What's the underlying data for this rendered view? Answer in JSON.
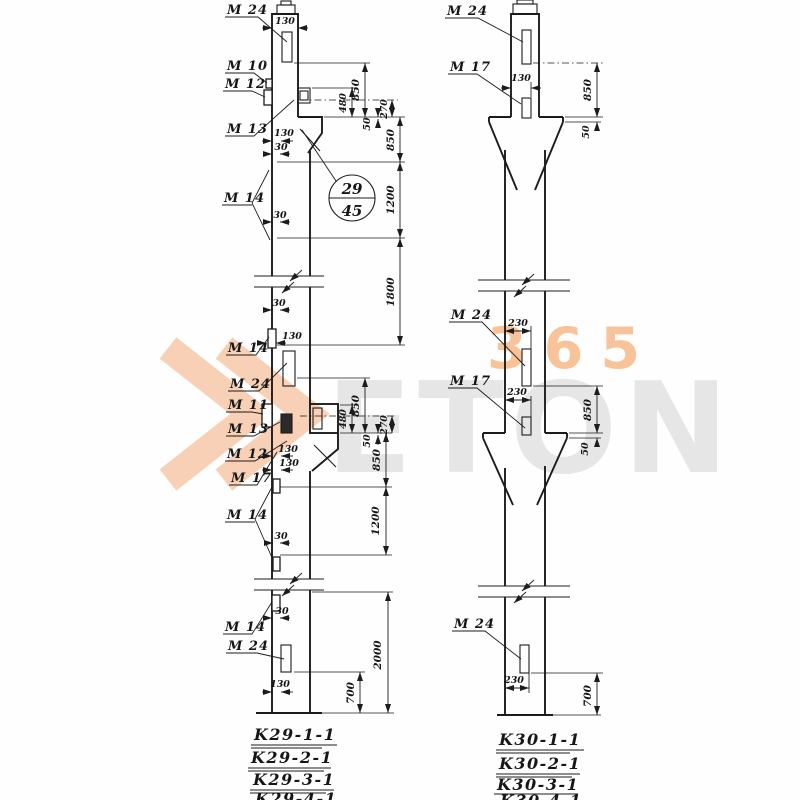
{
  "watermark": {
    "gray": "ETON",
    "orange": "365",
    "accent": "#f09246"
  },
  "left": {
    "callouts": {
      "c1": "M 24",
      "c2": "M 10",
      "c3": "M 12",
      "c4": "M 13",
      "c5": "M 14",
      "c6": "M 14",
      "c7": "M 24",
      "c8": "M 11",
      "c9": "M 13",
      "c10": "M 12",
      "c11": "M 17",
      "c12": "M 14",
      "c13": "M 14",
      "c14": "M 24"
    },
    "dims": {
      "neck": "130",
      "t850a": "850",
      "t480": "480",
      "t270": "270",
      "t50": "50",
      "t850b": "850",
      "t1200": "1200",
      "t1800": "1800",
      "p130a": "130",
      "p30a": "30",
      "p30b": "30",
      "m30a": "30",
      "m130a": "130",
      "m850a": "850",
      "m480": "480",
      "m270": "270",
      "m50": "50",
      "m850b": "850",
      "m1200": "1200",
      "m130b": "130",
      "m130c": "130",
      "m30b": "30",
      "b30": "30",
      "b130": "130",
      "b700": "700",
      "b2000": "2000"
    },
    "detail": {
      "top": "29",
      "bottom": "45"
    },
    "series": [
      "K29-1-1",
      "K29-2-1",
      "K29-3-1",
      "K29-4-1"
    ]
  },
  "right": {
    "callouts": {
      "c1": "M 24",
      "c2": "M 17",
      "c3": "M 24",
      "c4": "M 17",
      "c5": "M 24"
    },
    "dims": {
      "neck": "130",
      "t850": "850",
      "t50": "50",
      "m230a": "230",
      "m230b": "230",
      "m850": "850",
      "m50": "50",
      "b230": "230",
      "b700": "700"
    },
    "series": [
      "K30-1-1",
      "K30-2-1",
      "K30-3-1",
      "K30-4-1"
    ]
  }
}
